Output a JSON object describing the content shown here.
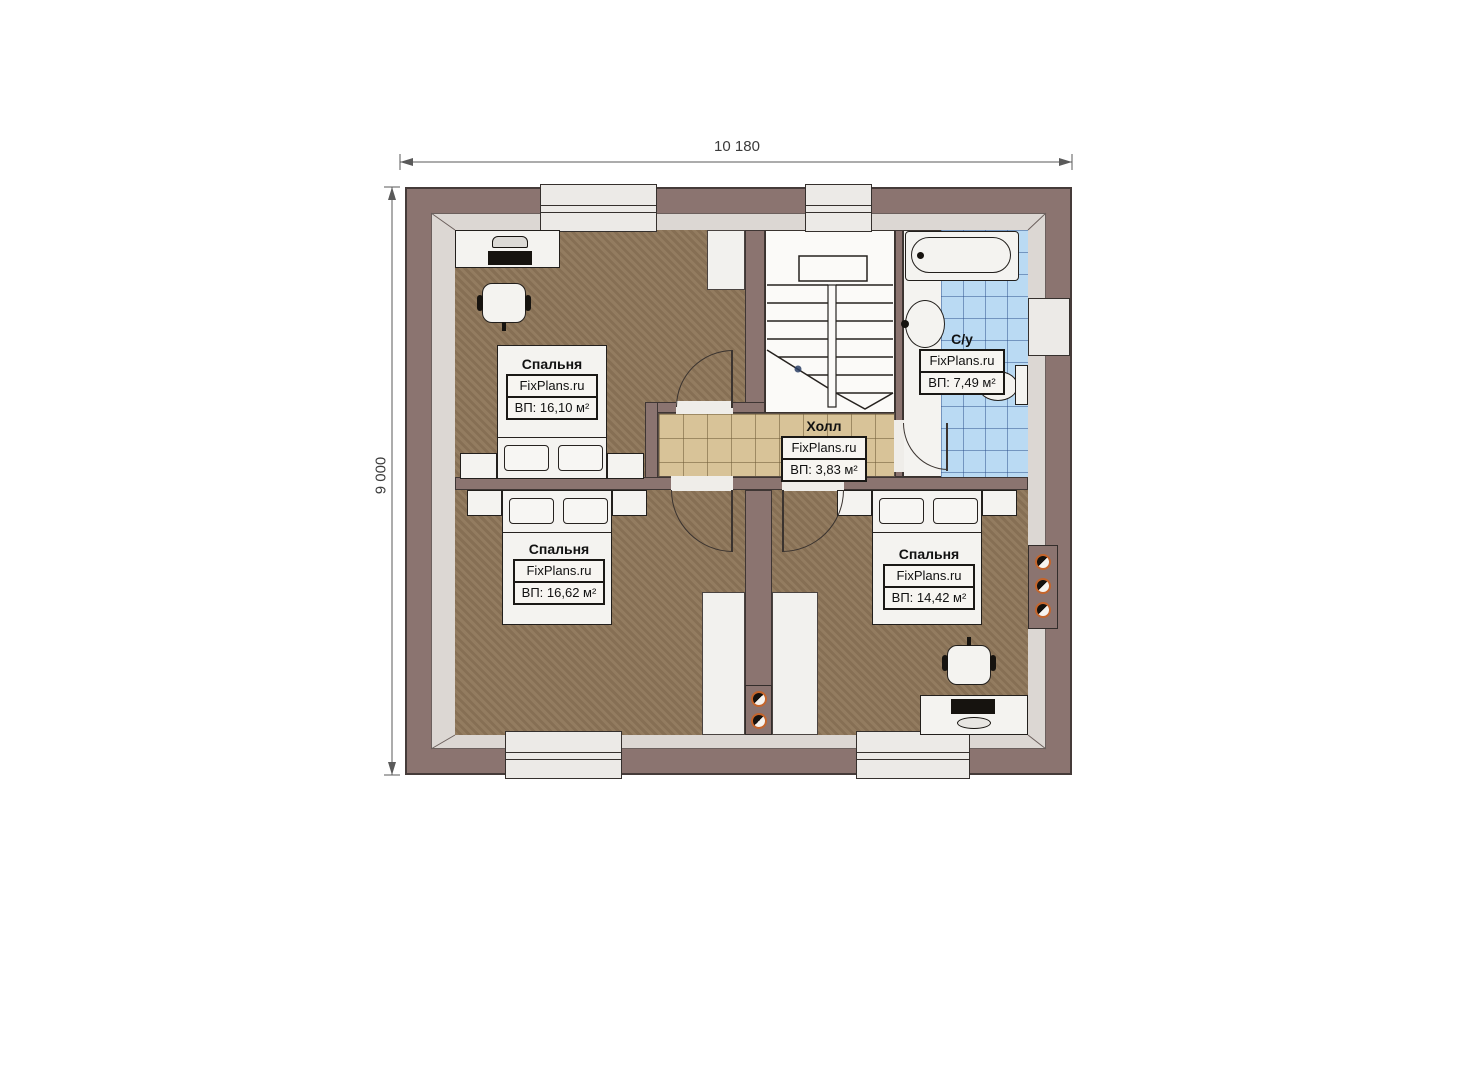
{
  "dimensions": {
    "width_label": "10 180",
    "height_label": "9 000"
  },
  "watermark": "FixPlans.ru",
  "rooms": [
    {
      "name": "Спальня",
      "area": "ВП: 16,10 м²"
    },
    {
      "name": "Спальня",
      "area": "ВП: 16,62 м²"
    },
    {
      "name": "Спальня",
      "area": "ВП: 14,42 м²"
    },
    {
      "name": "Холл",
      "area": "ВП: 3,83 м²"
    },
    {
      "name": "С/у",
      "area": "ВП: 7,49 м²"
    }
  ],
  "colors": {
    "wall": "#8b7470",
    "wall_liner": "#dcd7d3",
    "bedroom_floor": "#8d7558",
    "hall_tile": "#d8c398",
    "bathroom_tile": "#badaf3",
    "fixture_white": "#f4f3f0",
    "vent_ring": "#c4652c"
  }
}
